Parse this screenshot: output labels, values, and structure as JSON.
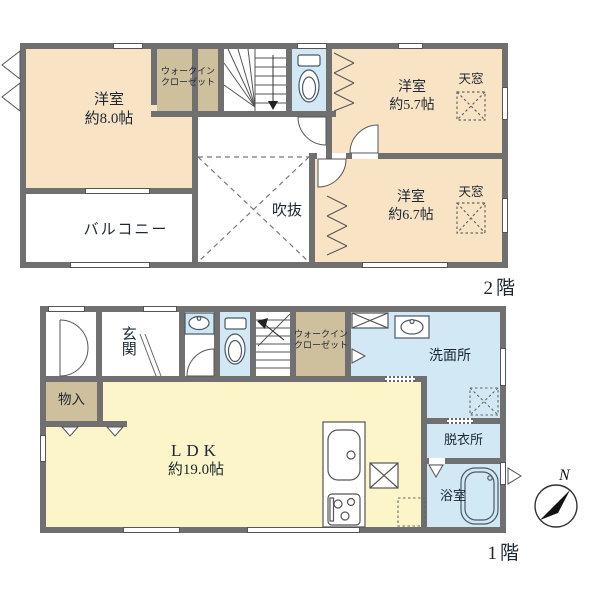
{
  "plan": {
    "floor2": {
      "floor_label": "2階",
      "room8_name": "洋室",
      "room8_size": "約8.0帖",
      "wic_line1": "ウォークイン",
      "wic_line2": "クローゼット",
      "room57_name": "洋室",
      "room57_size": "約5.7帖",
      "room67_name": "洋室",
      "room67_size": "約6.7帖",
      "skylight_a": "天窓",
      "skylight_b": "天窓",
      "void_label": "吹抜",
      "balcony_label": "バルコニー"
    },
    "floor1": {
      "floor_label": "1階",
      "genkan": "玄関",
      "monoire": "物入",
      "ldk_name": "LDK",
      "ldk_size": "約19.0帖",
      "wic_line1": "ウォークイン",
      "wic_line2": "クローゼット",
      "senmenjo": "洗面所",
      "datsuijo": "脱衣所",
      "yokushitsu": "浴室"
    },
    "compass": {
      "north": "N"
    },
    "colors": {
      "wall": "#707070",
      "western_room": "#f8e3c4",
      "closet": "#cfc09d",
      "ldk": "#fbf5c9",
      "wet_area": "#d2e8f4"
    }
  }
}
